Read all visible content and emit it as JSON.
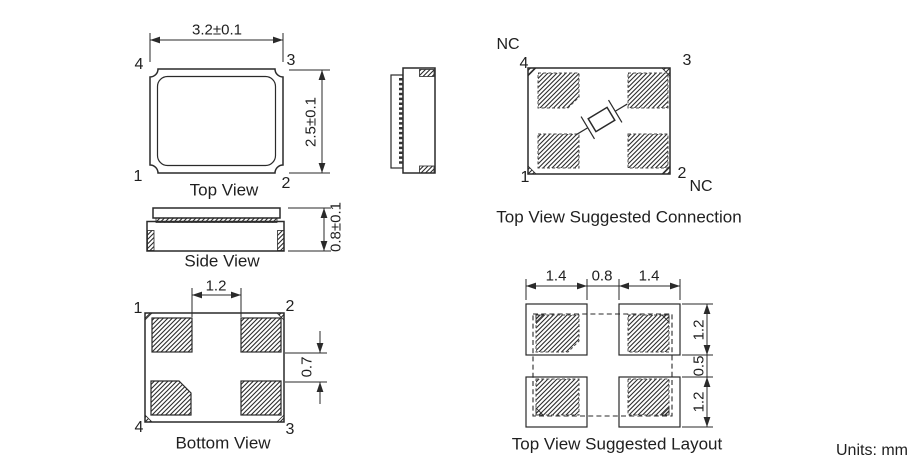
{
  "units_label": "Units: mm",
  "top_view": {
    "title": "Top View",
    "dim_width": "3.2±0.1",
    "dim_height": "2.5±0.1",
    "pin_top_left": "4",
    "pin_top_right": "3",
    "pin_bottom_left": "1",
    "pin_bottom_right": "2"
  },
  "side_view": {
    "title": "Side View",
    "dim_thickness": "0.8±0.1"
  },
  "bottom_view": {
    "title": "Bottom View",
    "dim_pad_inner_spacing": "1.2",
    "dim_pad_gap": "0.7",
    "pin_top_left": "1",
    "pin_top_right": "2",
    "pin_bottom_left": "4",
    "pin_bottom_right": "3"
  },
  "connection_view": {
    "title": "Top View Suggested Connection",
    "nc_top": "NC",
    "nc_bottom": "NC",
    "pin_top_left": "4",
    "pin_top_right": "3",
    "pin_bottom_left": "1",
    "pin_bottom_right": "2"
  },
  "layout_view": {
    "title": "Top View Suggested Layout",
    "dims_top": [
      "1.4",
      "0.8",
      "1.4"
    ],
    "dims_right": [
      "1.2",
      "0.5",
      "1.2"
    ]
  },
  "colors": {
    "line": "#2a2a2a",
    "text": "#1f1f1f",
    "background": "#ffffff"
  }
}
